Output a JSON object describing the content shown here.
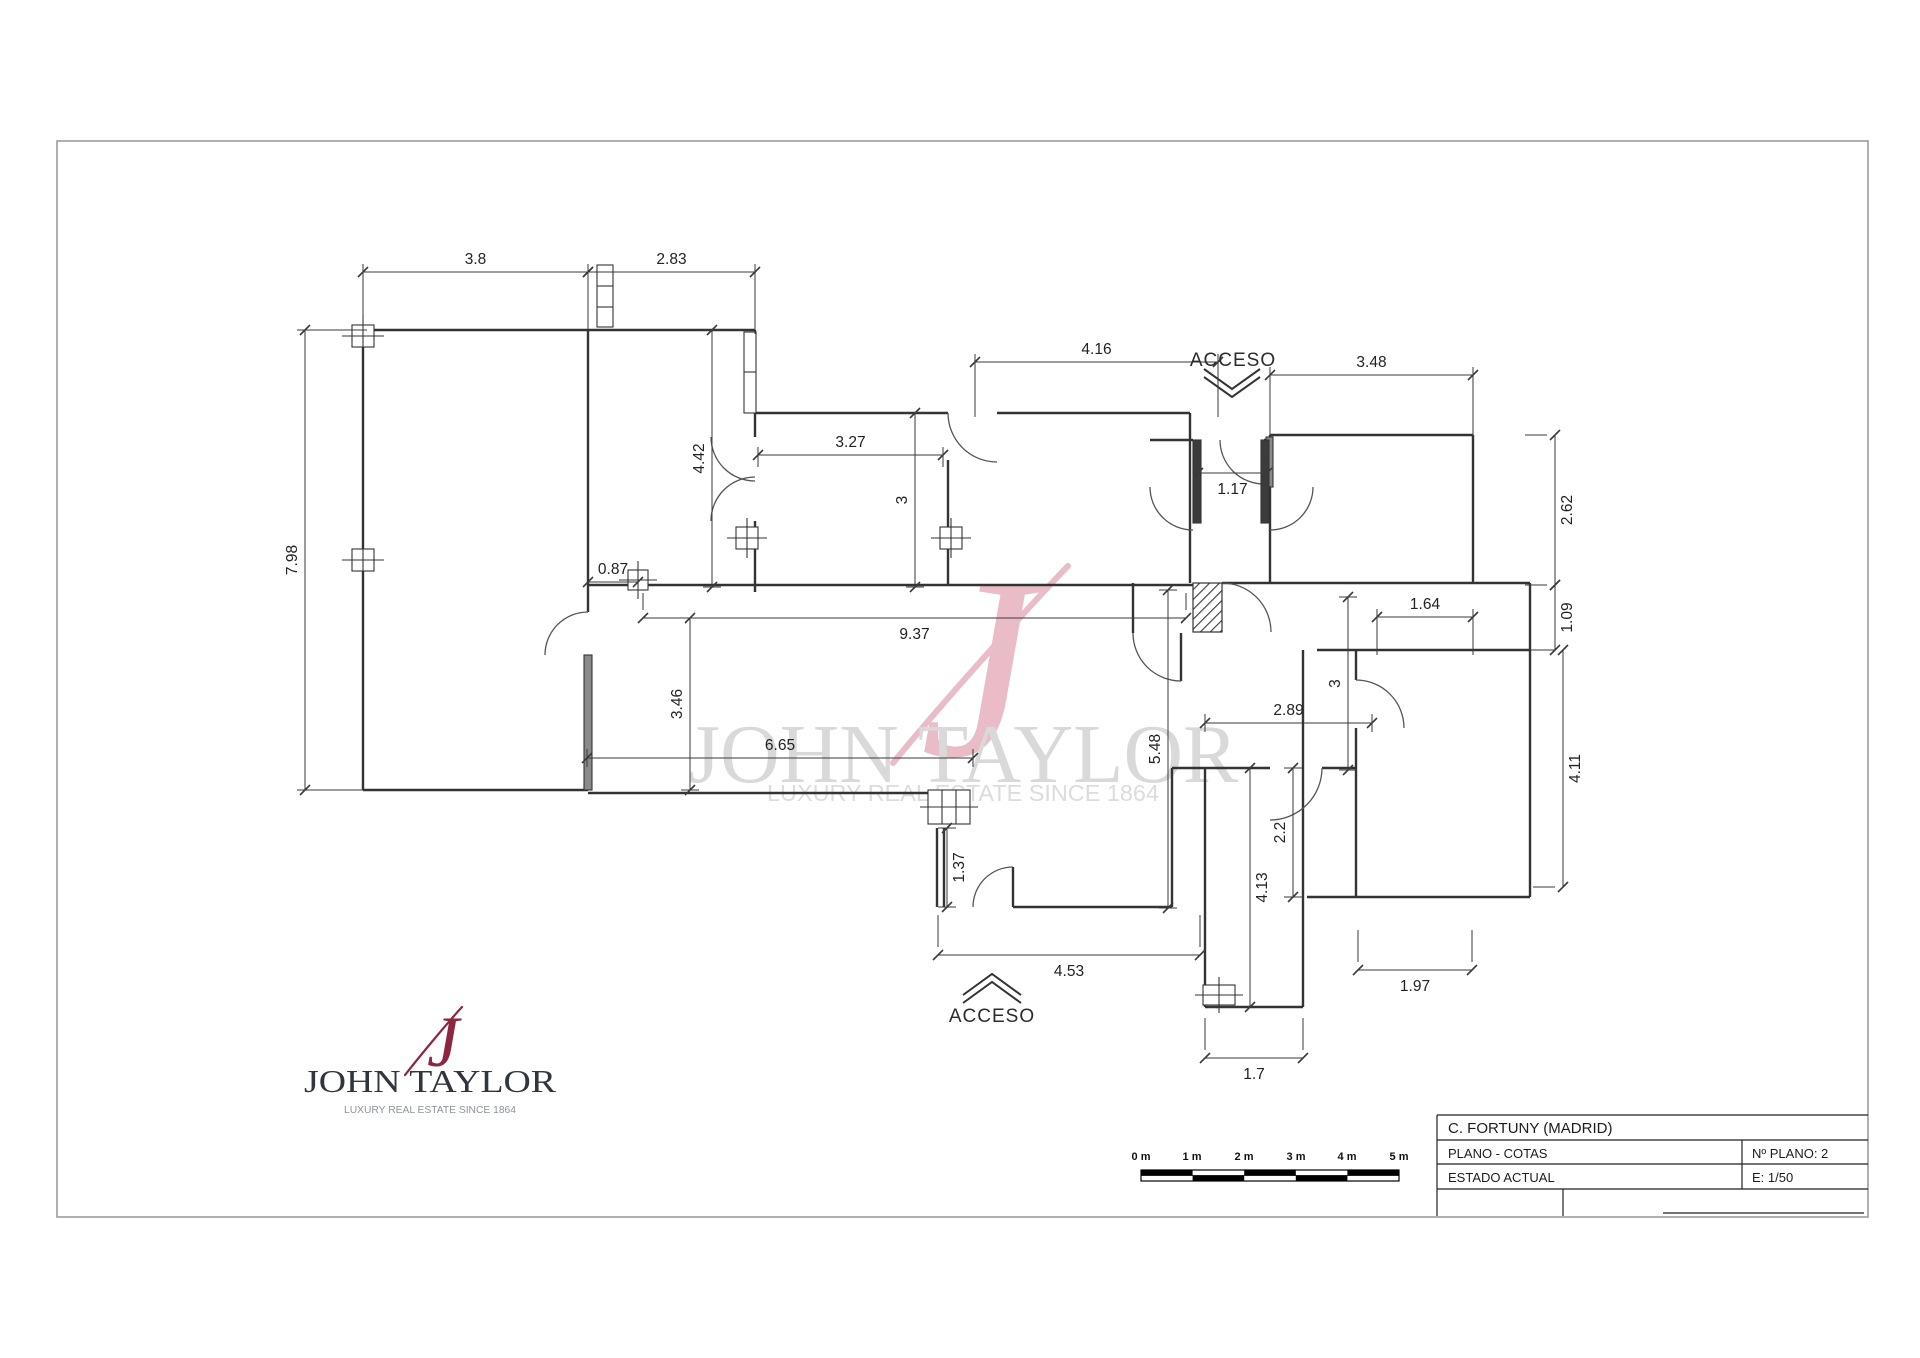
{
  "titleblock": {
    "project": "C. FORTUNY  (MADRID)",
    "plan": "PLANO  -  COTAS",
    "plan_no": "Nº PLANO:  2",
    "estado": "ESTADO  ACTUAL",
    "escala": "E: 1/50"
  },
  "labels": {
    "acceso_top": "ACCESO",
    "acceso_bottom": "ACCESO"
  },
  "watermark": {
    "monogram": "J",
    "name": "JOHN TAYLOR",
    "tagline": "LUXURY REAL ESTATE SINCE 1864"
  },
  "logo": {
    "monogram": "J",
    "name": "JOHN TAYLOR",
    "tagline": "LUXURY REAL ESTATE SINCE 1864"
  },
  "scalebar": {
    "labels": [
      "0 m",
      "1 m",
      "2 m",
      "3 m",
      "4 m",
      "5 m"
    ]
  },
  "colors": {
    "wall": "#333333",
    "door": "#555555",
    "dim": "#3a3a3a",
    "logo_red": "#8d2640",
    "logo_dark": "#31353d",
    "logo_gray": "#8d939c",
    "watermark_gray": "#d9d9d9",
    "watermark_pink": "#e9bcc8"
  },
  "plan": {
    "dimensions": [
      {
        "v": "3.8",
        "o": "h",
        "x": 363,
        "y": 272,
        "l": 225,
        "e": 62,
        "ts": -1
      },
      {
        "v": "2.83",
        "o": "h",
        "x": 588,
        "y": 272,
        "l": 167,
        "e": 62,
        "ts": -1
      },
      {
        "v": "4.16",
        "o": "h",
        "x": 975,
        "y": 362,
        "l": 243,
        "e": 55,
        "ts": -1
      },
      {
        "v": "3.48",
        "o": "h",
        "x": 1270,
        "y": 375,
        "l": 203,
        "e": 62,
        "ts": -1
      },
      {
        "v": "7.98",
        "o": "v",
        "x": 305,
        "y": 330,
        "l": 460,
        "e": 62,
        "ts": -1
      },
      {
        "v": "4.42",
        "o": "v",
        "x": 712,
        "y": 330,
        "l": 257,
        "e": 0,
        "ts": -1
      },
      {
        "v": "3.27",
        "o": "h",
        "x": 758,
        "y": 455,
        "l": 185,
        "e": 12,
        "ts": -1
      },
      {
        "v": "3",
        "o": "v",
        "x": 915,
        "y": 413,
        "l": 174,
        "e": 0,
        "ts": -1
      },
      {
        "v": "1.17",
        "o": "h",
        "x": 1198,
        "y": 473,
        "l": 69,
        "e": -20,
        "ts": 1
      },
      {
        "v": "2.62",
        "o": "v",
        "x": 1555,
        "y": 435,
        "l": 150,
        "e": -30,
        "ts": 1
      },
      {
        "v": "0.87",
        "o": "h",
        "x": 588,
        "y": 582,
        "l": 50,
        "e": 12,
        "ts": -1
      },
      {
        "v": "9.37",
        "o": "h",
        "x": 643,
        "y": 618,
        "l": 543,
        "e": -25,
        "ts": 1
      },
      {
        "v": "1.64",
        "o": "h",
        "x": 1377,
        "y": 617,
        "l": 96,
        "e": 38,
        "ts": -1
      },
      {
        "v": "1.09",
        "o": "v",
        "x": 1555,
        "y": 585,
        "l": 65,
        "e": -30,
        "ts": 1
      },
      {
        "v": "3.46",
        "o": "v",
        "x": 690,
        "y": 618,
        "l": 172,
        "e": 0,
        "ts": -1
      },
      {
        "v": "3",
        "o": "v",
        "x": 1348,
        "y": 597,
        "l": 173,
        "e": 0,
        "ts": -1
      },
      {
        "v": "2.89",
        "o": "h",
        "x": 1205,
        "y": 723,
        "l": 167,
        "e": 0,
        "ts": -1
      },
      {
        "v": "5.48",
        "o": "v",
        "x": 1168,
        "y": 590,
        "l": 318,
        "e": 0,
        "ts": -1
      },
      {
        "v": "6.65",
        "o": "h",
        "x": 587,
        "y": 758,
        "l": 386,
        "e": 0,
        "ts": -1
      },
      {
        "v": "4.11",
        "o": "v",
        "x": 1563,
        "y": 650,
        "l": 237,
        "e": -30,
        "ts": 1
      },
      {
        "v": "2.2",
        "o": "v",
        "x": 1293,
        "y": 768,
        "l": 129,
        "e": 0,
        "ts": -1
      },
      {
        "v": "1.37",
        "o": "v",
        "x": 947,
        "y": 828,
        "l": 79,
        "e": 0,
        "ts": 1
      },
      {
        "v": "4.13",
        "o": "v",
        "x": 1250,
        "y": 768,
        "l": 239,
        "e": -40,
        "ts": 1
      },
      {
        "v": "4.53",
        "o": "h",
        "x": 938,
        "y": 955,
        "l": 262,
        "e": -40,
        "ts": 1
      },
      {
        "v": "1.97",
        "o": "h",
        "x": 1358,
        "y": 970,
        "l": 114,
        "e": -40,
        "ts": 1
      },
      {
        "v": "1.7",
        "o": "h",
        "x": 1205,
        "y": 1058,
        "l": 98,
        "e": -40,
        "ts": 1
      }
    ]
  }
}
